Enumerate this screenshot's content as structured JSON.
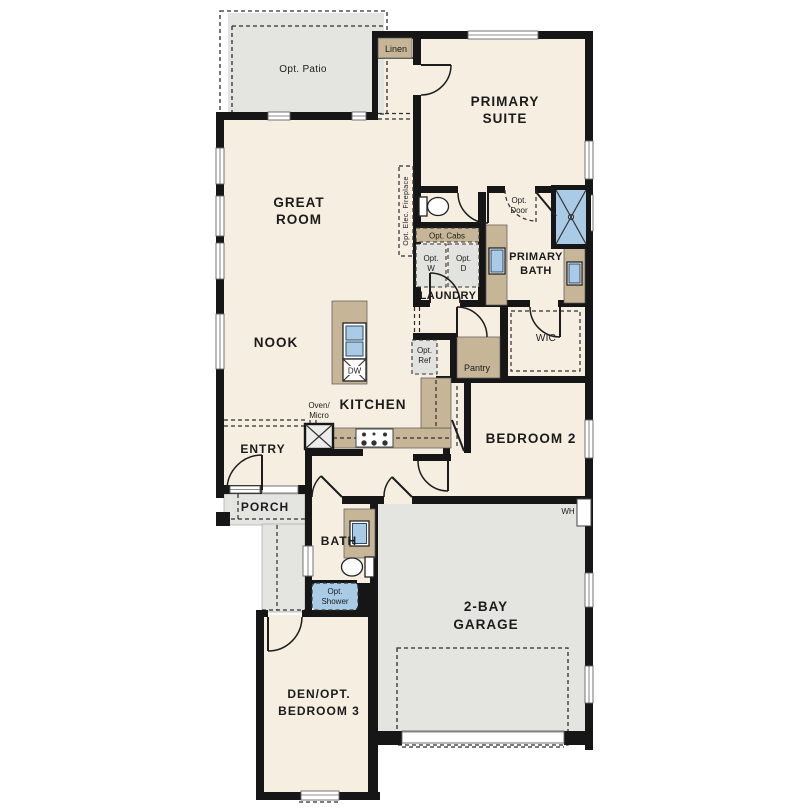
{
  "colors": {
    "floor": "#f5eee1",
    "concrete": "#e4e4e0",
    "cabinet_tan": "#c6b697",
    "fixture_blue": "#a9cbe5",
    "wall_black": "#161616"
  },
  "labels": {
    "opt_patio": "Opt. Patio",
    "linen": "Linen",
    "primary_suite": [
      "PRIMARY",
      "SUITE"
    ],
    "great_room": [
      "GREAT",
      "ROOM"
    ],
    "fireplace": "Opt. Elec. Fireplace",
    "opt_door": [
      "Opt.",
      "Door"
    ],
    "opt_cabs": "Opt. Cabs",
    "opt_w": [
      "Opt.",
      "W"
    ],
    "opt_d": [
      "Opt.",
      "D"
    ],
    "laundry": "LAUNDRY",
    "primary_bath": [
      "PRIMARY",
      "BATH"
    ],
    "wic": "WIC",
    "nook": "NOOK",
    "dw": "DW",
    "opt_ref": [
      "Opt.",
      "Ref"
    ],
    "pantry": "Pantry",
    "kitchen": "KITCHEN",
    "oven_micro": [
      "Oven/",
      "Micro"
    ],
    "entry": "ENTRY",
    "porch": "PORCH",
    "bedroom2": "BEDROOM 2",
    "wh": "WH",
    "bath": "BATH",
    "opt_shower": [
      "Opt.",
      "Shower"
    ],
    "garage": [
      "2-BAY",
      "GARAGE"
    ],
    "den": [
      "DEN/OPT.",
      "BEDROOM 3"
    ]
  }
}
